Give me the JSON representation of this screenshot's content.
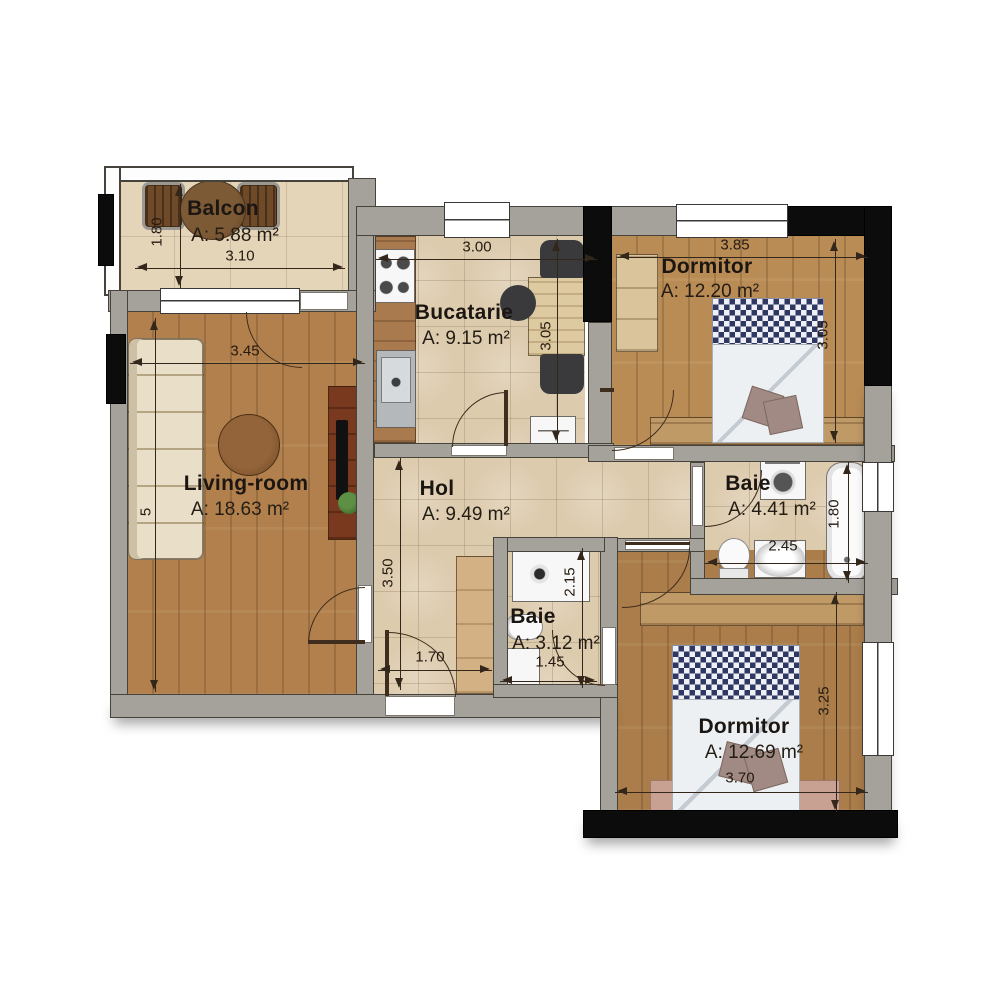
{
  "title": "Apartment floor plan",
  "rooms": {
    "balcon": {
      "name": "Balcon",
      "area": "A: 5.88 m²",
      "dim_w": "3.10",
      "dim_h": "1.80"
    },
    "bucatarie": {
      "name": "Bucatarie",
      "area": "A: 9.15 m²",
      "dim_w": "3.00",
      "dim_h": "3.05"
    },
    "dormitor1": {
      "name": "Dormitor",
      "area": "A: 12.20 m²",
      "dim_w": "3.85",
      "dim_h": "3.05"
    },
    "living": {
      "name": "Living-room",
      "area": "A: 18.63 m²",
      "dim_w": "3.45",
      "dim_h": "5"
    },
    "hol": {
      "name": "Hol",
      "area": "A: 9.49 m²",
      "dim_w": "1.70",
      "dim_h": "3.50"
    },
    "baie_mare": {
      "name": "Baie",
      "area": "A: 4.41 m²",
      "dim_w": "2.45",
      "dim_h": "1.80"
    },
    "baie_mica": {
      "name": "Baie",
      "area": "A: 3.12 m²",
      "dim_w": "1.45",
      "dim_h": "2.15"
    },
    "dormitor2": {
      "name": "Dormitor",
      "area": "A: 12.69 m²",
      "dim_w": "3.70",
      "dim_h": "3.25"
    }
  },
  "colors": {
    "wall_gray": "#a5a29c",
    "structural_black": "#0c0c0c",
    "tile_floor": "#ddcbae",
    "wood_floor_light": "#b98c55",
    "wood_floor_dark": "#aa7d4a",
    "dimension_line": "#33261a",
    "bed_checker": "#2f3863"
  },
  "fixtures": [
    "balcony-table",
    "balcony-chair",
    "stove",
    "kitchen-sink",
    "kitchen-table",
    "kitchen-chair",
    "radiator",
    "wardrobe",
    "double-bed",
    "sofa",
    "coffee-table",
    "tv-unit",
    "tv",
    "plant",
    "hall-cabinet",
    "shower",
    "toilet",
    "washbasin",
    "washing-machine",
    "bathtub",
    "dresser",
    "rug"
  ]
}
